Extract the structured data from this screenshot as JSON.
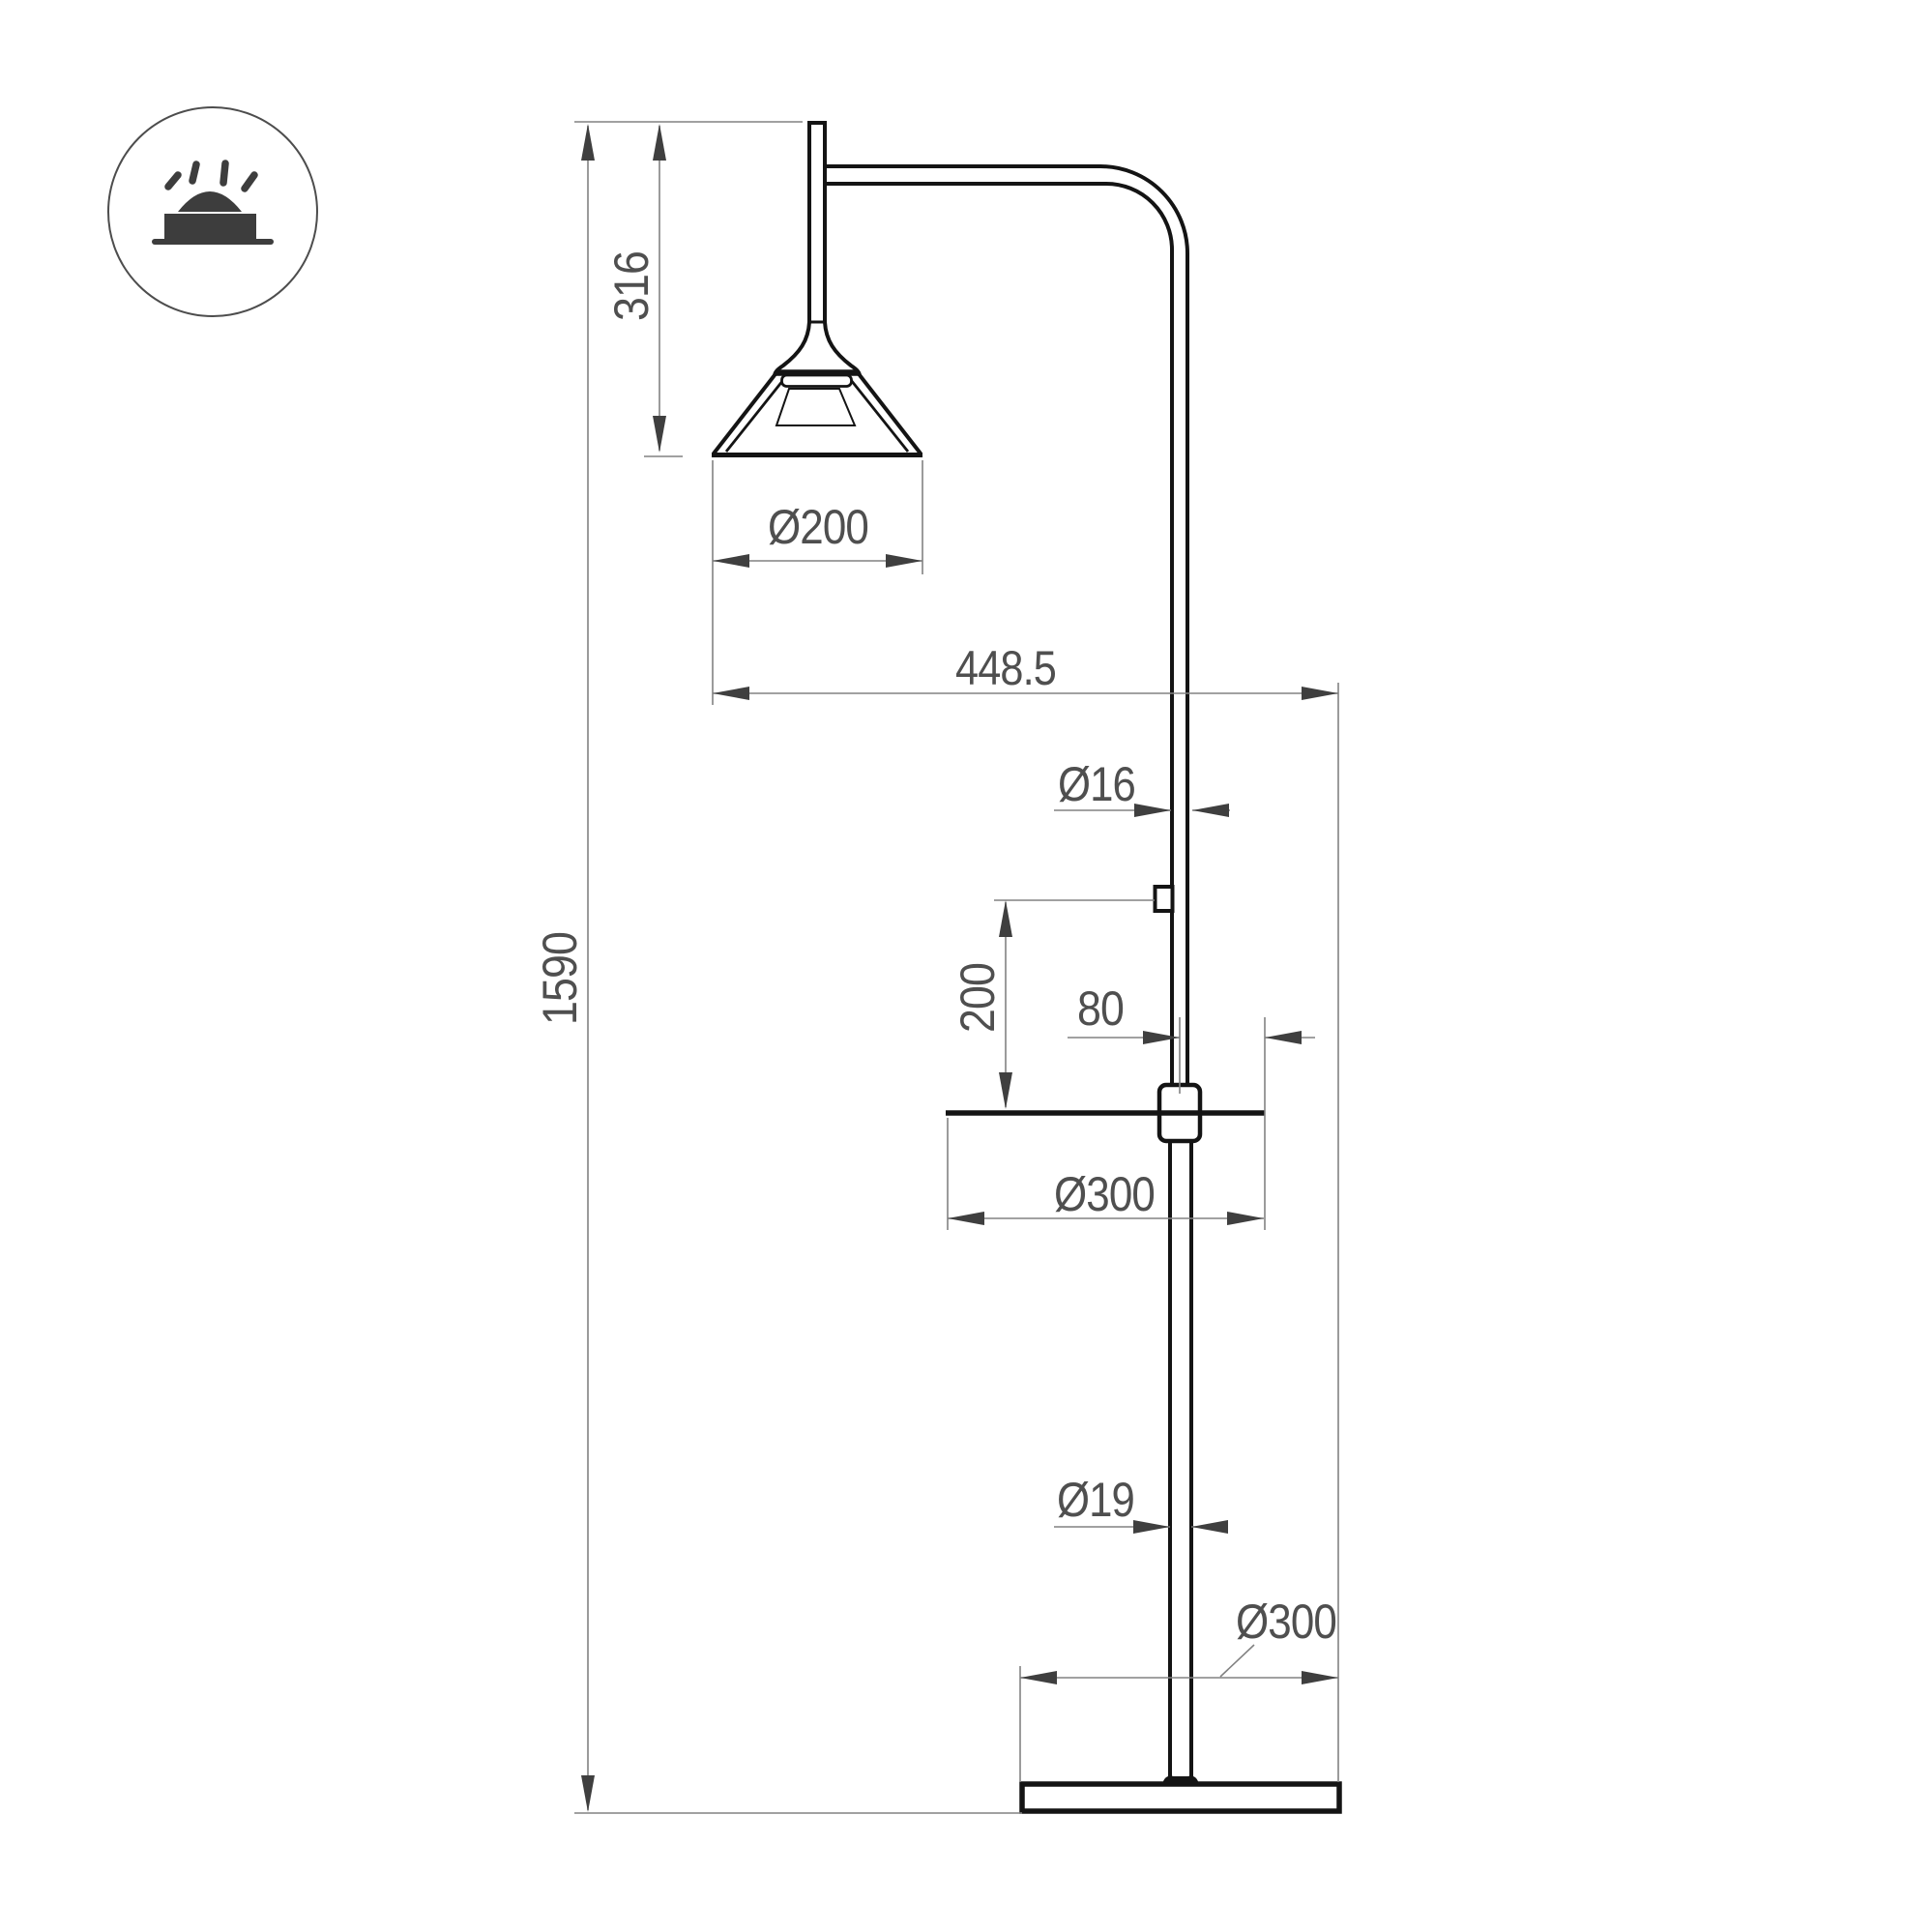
{
  "meta": {
    "type": "technical-dimension-drawing",
    "subject": "floor lamp with shelf",
    "units": "mm"
  },
  "colors": {
    "background": "#ffffff",
    "structure": "#141414",
    "dimension_line": "#828282",
    "arrowhead": "#3f3f3f",
    "text": "#4f4f4f",
    "icon": "#3d3d3d",
    "icon_circle": "#4d4d4d"
  },
  "icon": {
    "name": "surface-mounted-light-icon"
  },
  "dimensions": {
    "total_height": {
      "label": "1590",
      "orientation": "vertical"
    },
    "head_drop": {
      "label": "316",
      "orientation": "vertical"
    },
    "shade_diameter": {
      "label": "Ø200",
      "orientation": "horizontal"
    },
    "projection": {
      "label": "448.5",
      "orientation": "horizontal"
    },
    "upper_pole_diameter": {
      "label": "Ø16",
      "orientation": "horizontal"
    },
    "switch_above_table": {
      "label": "200",
      "orientation": "vertical"
    },
    "table_side_offset": {
      "label": "80",
      "orientation": "horizontal"
    },
    "table_diameter": {
      "label": "Ø300",
      "orientation": "horizontal"
    },
    "lower_pole_diameter": {
      "label": "Ø19",
      "orientation": "horizontal"
    },
    "base_diameter": {
      "label": "Ø300",
      "orientation": "horizontal"
    }
  }
}
